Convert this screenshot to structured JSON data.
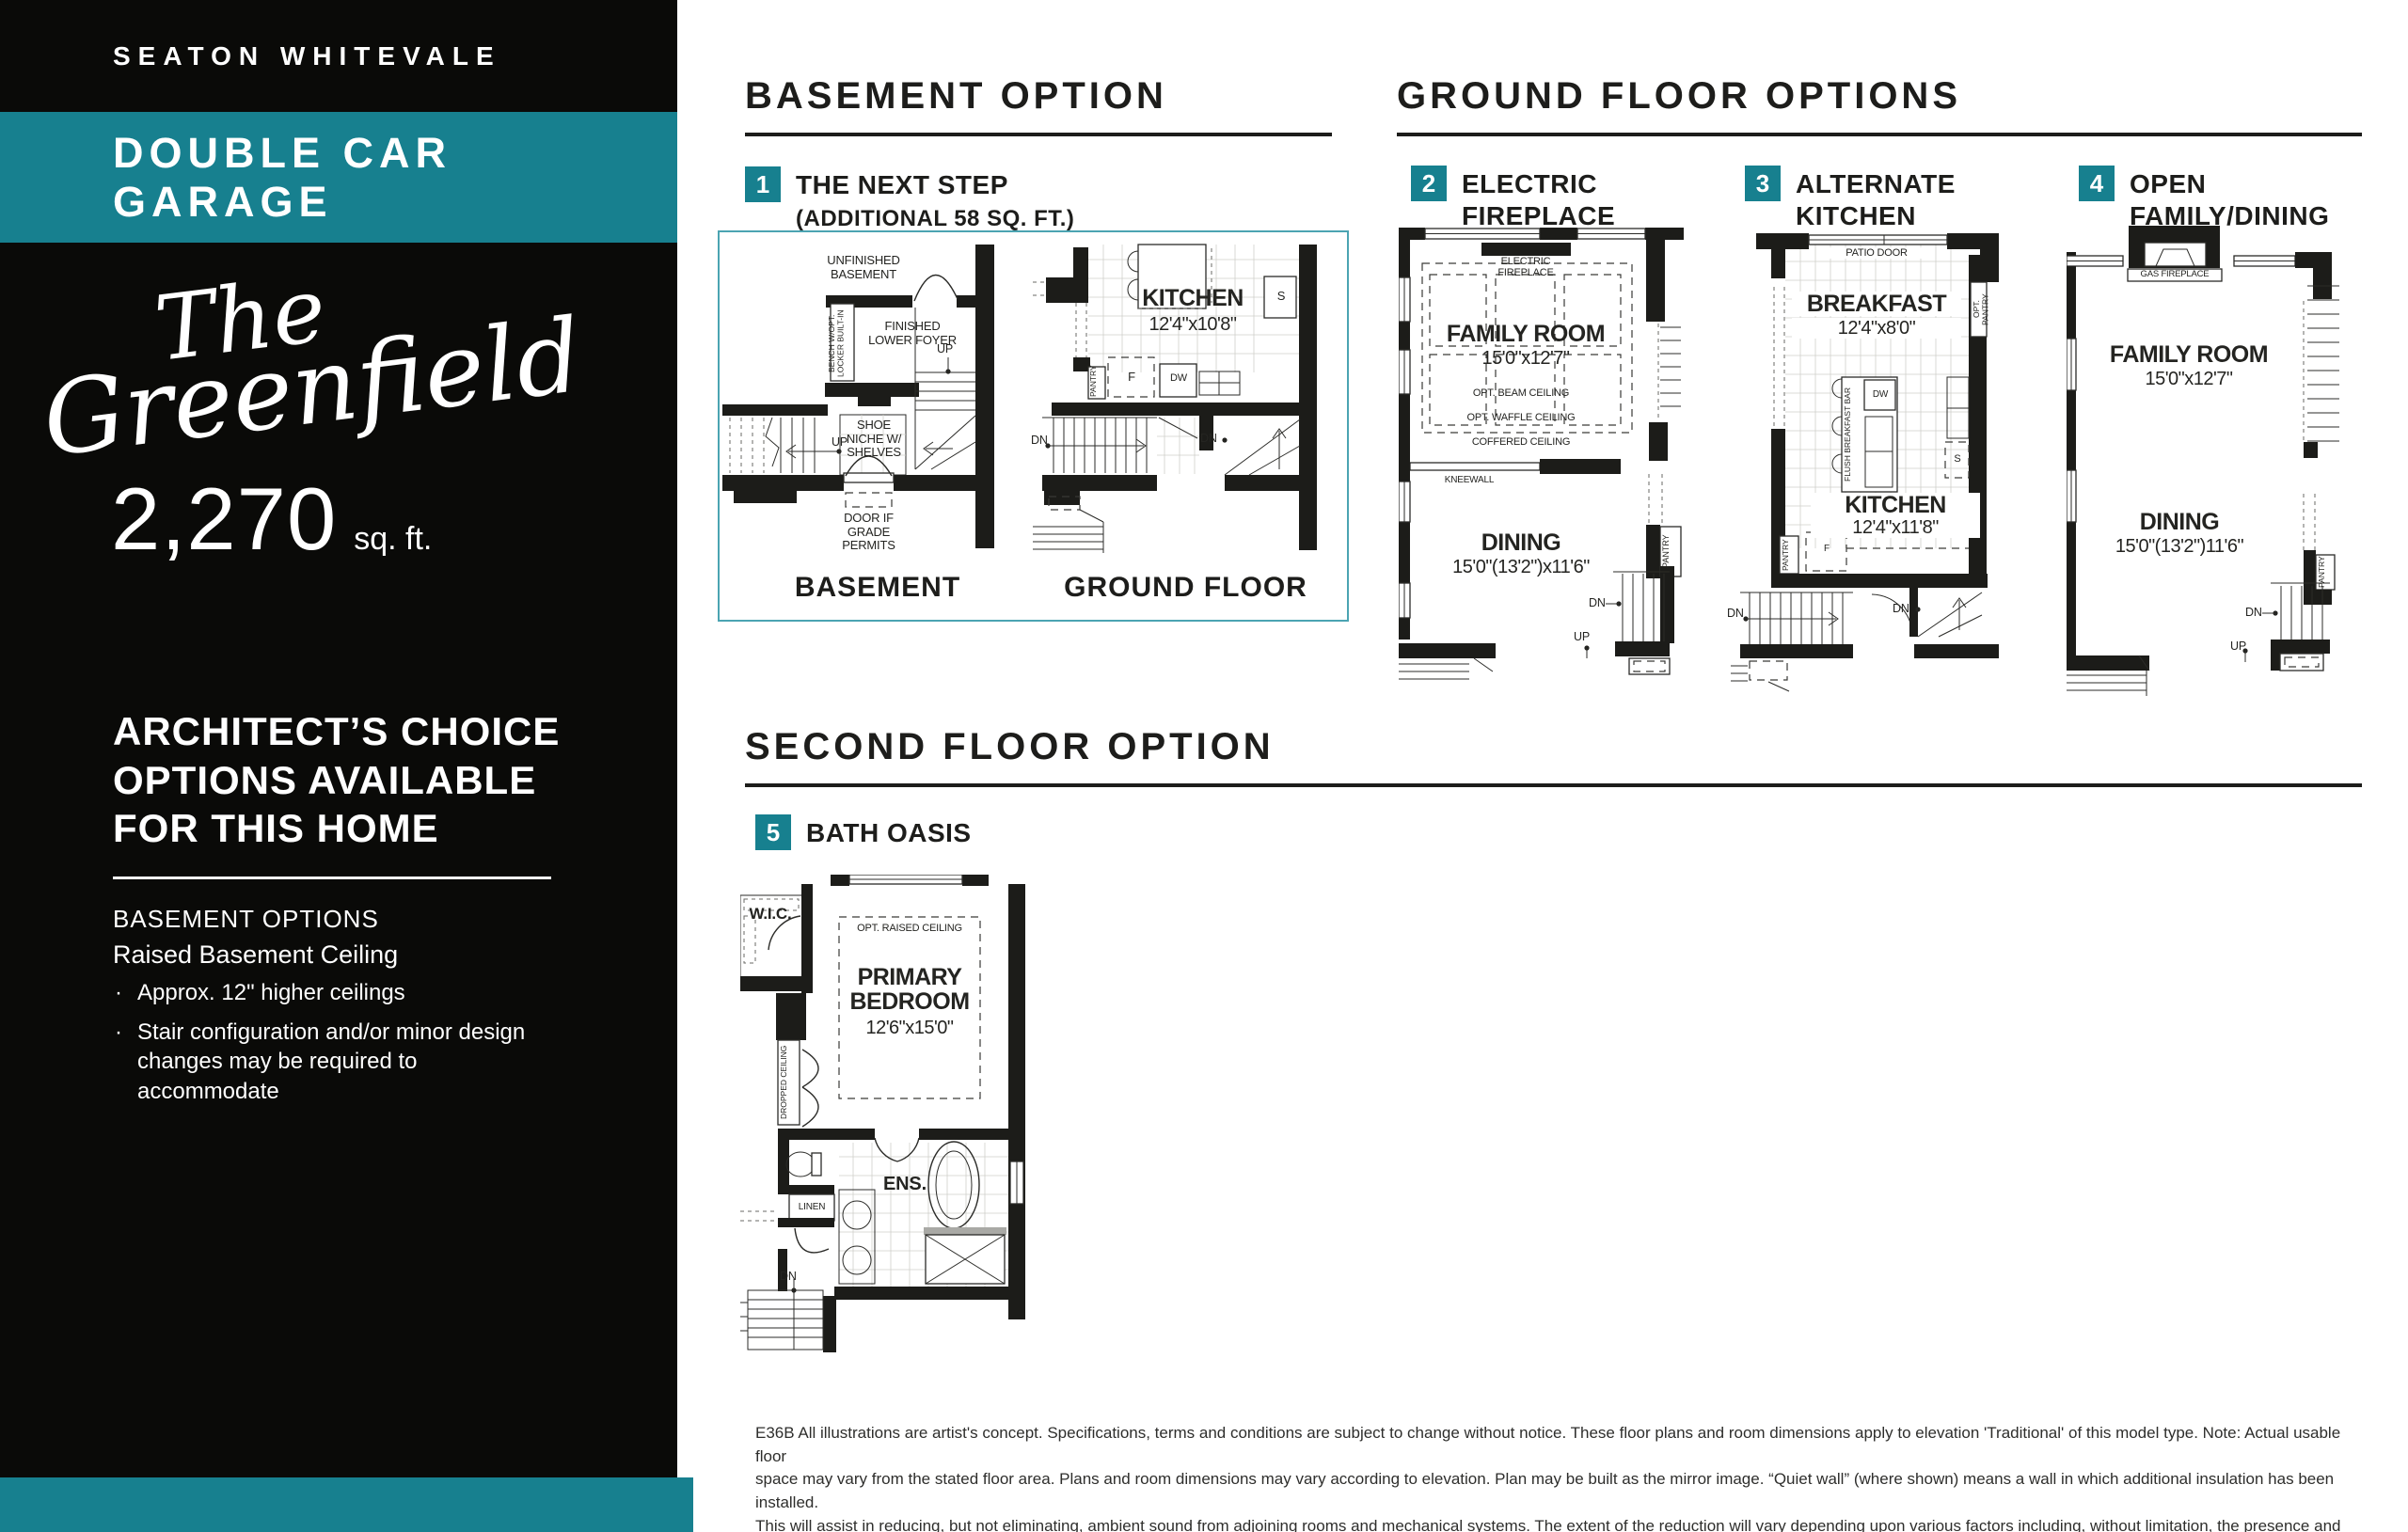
{
  "colors": {
    "accent": "#17808F",
    "accent_border": "#4BA4B2",
    "ink": "#1d1d1b"
  },
  "sidebar": {
    "community": "SEATON WHITEVALE",
    "banner": "DOUBLE CAR GARAGE",
    "model_prefix": "The",
    "model_name": "Greenfield",
    "sqft": "2,270",
    "sqft_unit": "sq. ft.",
    "architects_lines": [
      "ARCHITECT’S CHOICE",
      "OPTIONS AVAILABLE",
      "FOR THIS HOME"
    ],
    "options_heading": "BASEMENT OPTIONS",
    "option_name": "Raised Basement Ceiling",
    "bullets": [
      "Approx. 12\" higher ceilings",
      "Stair configuration and/or minor design changes may be required to accommodate"
    ]
  },
  "basement_section": {
    "heading": "BASEMENT OPTION",
    "badge": "1",
    "title": "THE NEXT STEP",
    "subtitle": "(ADDITIONAL 58 SQ. FT.)"
  },
  "ground_section": {
    "heading": "GROUND FLOOR OPTIONS",
    "options": [
      {
        "badge": "2",
        "title": "ELECTRIC FIREPLACE"
      },
      {
        "badge": "3",
        "title": "ALTERNATE KITCHEN"
      },
      {
        "badge": "4",
        "title": "OPEN FAMILY/DINING"
      }
    ]
  },
  "second_section": {
    "heading": "SECOND FLOOR OPTION",
    "badge": "5",
    "title": "BATH OASIS"
  },
  "plans": {
    "basement": {
      "caption": "BASEMENT",
      "labels": {
        "unfinished": "UNFINISHED BASEMENT",
        "bench": "BENCH W/OPT. LOCKER BUILT-IN",
        "foyer": "FINISHED LOWER FOYER",
        "up1": "UP",
        "up2": "UP",
        "shoe": "SHOE NICHE W/ SHELVES",
        "door_grade": "DOOR IF GRADE PERMITS"
      }
    },
    "ground": {
      "caption": "GROUND FLOOR",
      "labels": {
        "room": "KITCHEN",
        "dims": "12'4\"x10'8\"",
        "pantry": "PANTRY",
        "f": "F",
        "dw": "DW",
        "s": "S",
        "dn1": "DN",
        "dn2": "DN"
      }
    },
    "opt2": {
      "labels": {
        "fireplace": "ELECTRIC FIREPLACE",
        "room1": "FAMILY ROOM",
        "dims1": "15'0\"x12'7\"",
        "beam": "OPT. BEAM CEILING",
        "waffle": "OPT. WAFFLE CEILING",
        "coffered": "COFFERED CEILING",
        "kneewall": "KNEEWALL",
        "room2": "DINING",
        "dims2": "15'0\"(13'2\")x11'6\"",
        "pantry": "PANTRY",
        "dn": "DN",
        "up": "UP"
      }
    },
    "opt3": {
      "labels": {
        "patio": "PATIO DOOR",
        "room1": "BREAKFAST",
        "dims1": "12'4\"x8'0\"",
        "opt_pantry": "OPT. PANTRY",
        "bar": "FLUSH BREAKFAST BAR",
        "dw": "DW",
        "s": "S",
        "room2": "KITCHEN",
        "dims2": "12'4\"x11'8\"",
        "f": "F",
        "pantry": "PANTRY",
        "dn1": "DN",
        "dn2": "DN"
      }
    },
    "opt4": {
      "labels": {
        "fireplace": "GAS FIREPLACE",
        "room1": "FAMILY ROOM",
        "dims1": "15'0\"x12'7\"",
        "room2": "DINING",
        "dims2": "15'0\"(13'2\")11'6\"",
        "pantry": "PANTRY",
        "dn": "DN",
        "up": "UP"
      }
    },
    "bath": {
      "labels": {
        "wic": "W.I.C.",
        "raised": "OPT. RAISED CEILING",
        "room": "PRIMARY BEDROOM",
        "dims": "12'6\"x15'0\"",
        "dropped": "DROPPED CEILING",
        "ens": "ENS.",
        "linen": "LINEN",
        "dn": "DN"
      }
    }
  },
  "footer": {
    "lines": [
      "E36B All illustrations are artist's concept. Specifications, terms and conditions are subject to change without notice. These floor plans and room dimensions apply to elevation 'Traditional' of this model type. Note: Actual usable floor",
      "space may vary from the stated floor area. Plans and room dimensions may vary according to elevation. Plan may be built as the mirror image. “Quiet wall” (where shown) means a wall in which additional insulation has been installed.",
      "This will assist in reducing, but not eliminating, ambient sound from adjoining rooms and mechanical systems. The extent of the reduction will vary depending upon various factors including, without limitation, the presence and extent",
      "of mechanical systems located in the wall. Please consult your sales representative. E.&O.E. July 2024 – Copyright 2024 – Mattamy Homes Limited."
    ]
  }
}
